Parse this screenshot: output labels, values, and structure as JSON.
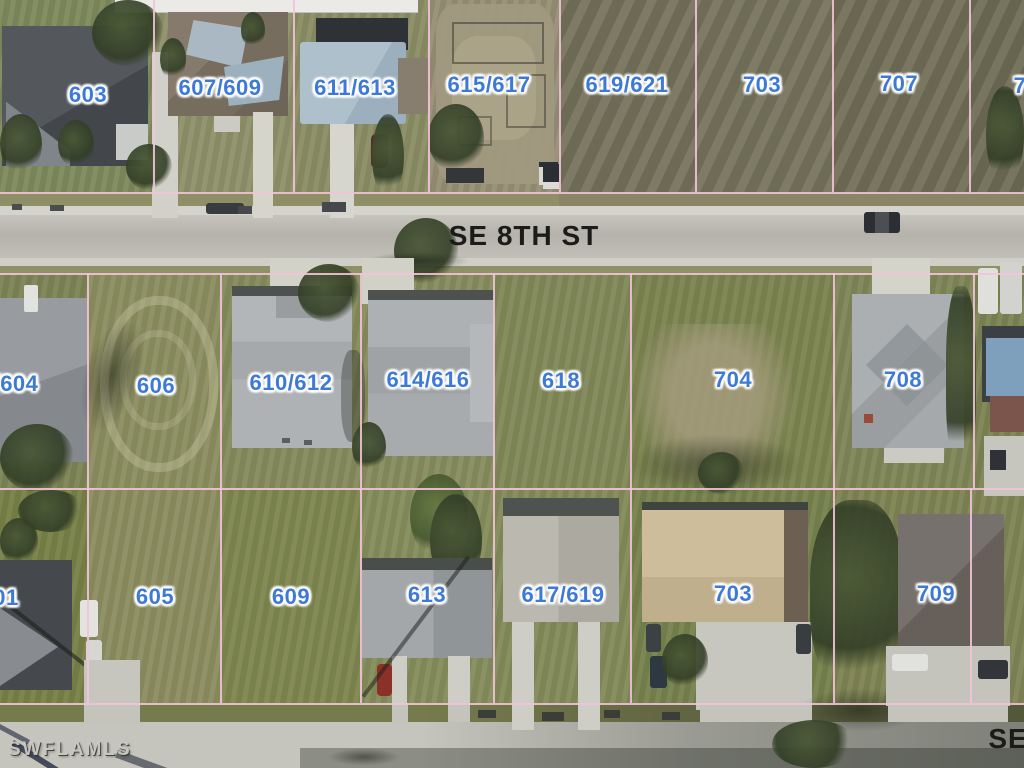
{
  "map": {
    "parcel_labels": [
      {
        "id": "603",
        "text": "603",
        "x": 88,
        "y": 95
      },
      {
        "id": "607-609",
        "text": "607/609",
        "x": 220,
        "y": 88
      },
      {
        "id": "611-613",
        "text": "611/613",
        "x": 355,
        "y": 88
      },
      {
        "id": "615-617",
        "text": "615/617",
        "x": 489,
        "y": 85
      },
      {
        "id": "619-621",
        "text": "619/621",
        "x": 627,
        "y": 85
      },
      {
        "id": "703-north",
        "text": "703",
        "x": 762,
        "y": 85
      },
      {
        "id": "707",
        "text": "707",
        "x": 899,
        "y": 84
      },
      {
        "id": "7xx-partial",
        "text": "7",
        "x": 1020,
        "y": 86
      },
      {
        "id": "604-partial",
        "text": "/604",
        "x": 16,
        "y": 384
      },
      {
        "id": "606",
        "text": "606",
        "x": 156,
        "y": 386
      },
      {
        "id": "610-612",
        "text": "610/612",
        "x": 291,
        "y": 383
      },
      {
        "id": "614-616",
        "text": "614/616",
        "x": 428,
        "y": 380
      },
      {
        "id": "618",
        "text": "618",
        "x": 561,
        "y": 381
      },
      {
        "id": "704",
        "text": "704",
        "x": 733,
        "y": 380
      },
      {
        "id": "708",
        "text": "708",
        "x": 903,
        "y": 380
      },
      {
        "id": "601-partial",
        "text": "01",
        "x": 6,
        "y": 598
      },
      {
        "id": "605",
        "text": "605",
        "x": 155,
        "y": 597
      },
      {
        "id": "609",
        "text": "609",
        "x": 291,
        "y": 597
      },
      {
        "id": "613",
        "text": "613",
        "x": 427,
        "y": 595
      },
      {
        "id": "617-619",
        "text": "617/619",
        "x": 563,
        "y": 595
      },
      {
        "id": "703-south",
        "text": "703",
        "x": 733,
        "y": 594
      },
      {
        "id": "709",
        "text": "709",
        "x": 936,
        "y": 594
      }
    ],
    "street_labels": [
      {
        "id": "se-8th-st",
        "text": "SE 8TH ST",
        "x": 524,
        "y": 236
      },
      {
        "id": "se-partial",
        "text": "SE",
        "x": 1008,
        "y": 739
      }
    ],
    "watermark": {
      "text": "SWFLAMLS",
      "x": 8,
      "y": 750
    }
  },
  "colors": {
    "parcel_label_blue": "#3d79d6",
    "parcel_line_pink": "#f2c3d8",
    "street_label_black": "#1b1b19",
    "watermark_gray": "#c8c7c1"
  }
}
